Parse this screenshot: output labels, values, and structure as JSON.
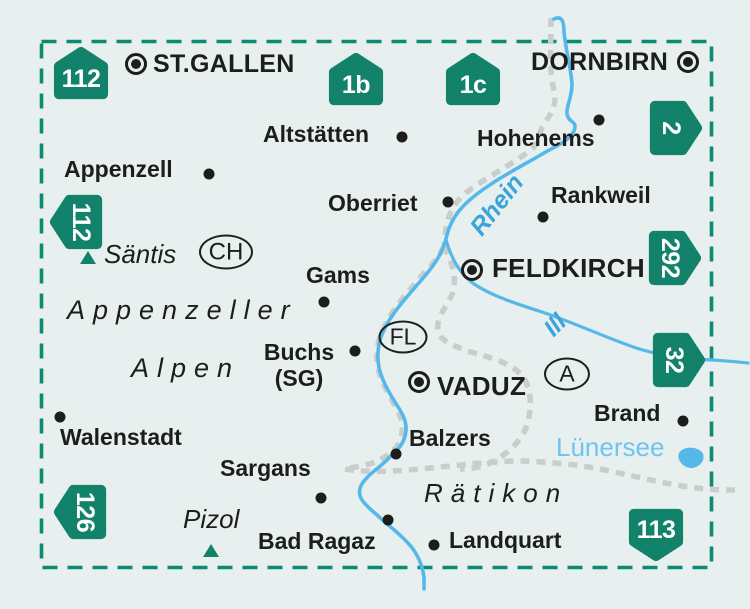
{
  "colors": {
    "background": "#e7f0ee",
    "badge_green": "#12826a",
    "border_dash_teal": "#0c8a72",
    "river_blue": "#56b8e9",
    "river_label_blue": "#3ba4dc",
    "lake_label_blue": "#70c4ee",
    "country_border_gray": "#c9cdcb",
    "text_black": "#1d1d1b"
  },
  "cities": {
    "st_gallen": "ST.GALLEN",
    "dornbirn": "DORNBIRN",
    "feldkirch": "FELDKIRCH",
    "vaduz": "VADUZ"
  },
  "towns": {
    "altstaetten": "Altstätten",
    "appenzell": "Appenzell",
    "hohenems": "Hohenems",
    "rankweil": "Rankweil",
    "oberriet": "Oberriet",
    "gams": "Gams",
    "buchs_line1": "Buchs",
    "buchs_line2": "(SG)",
    "walenstadt": "Walenstadt",
    "brand": "Brand",
    "balzers": "Balzers",
    "sargans": "Sargans",
    "bad_ragaz": "Bad Ragaz",
    "landquart": "Landquart"
  },
  "regions": {
    "appenzeller": "Appenzeller",
    "alpen": "Alpen",
    "raetikon": "Rätikon"
  },
  "peaks": {
    "saentis": "Säntis",
    "pizol": "Pizol"
  },
  "waters": {
    "rhein": "Rhein",
    "ill": "Ill",
    "luenersee": "Lünersee"
  },
  "country_codes": {
    "ch": "CH",
    "fl": "FL",
    "a": "A"
  },
  "badges": [
    {
      "label": "112",
      "orientation": "up"
    },
    {
      "label": "1b",
      "orientation": "up"
    },
    {
      "label": "1c",
      "orientation": "up"
    },
    {
      "label": "2",
      "orientation": "right"
    },
    {
      "label": "112",
      "orientation": "left"
    },
    {
      "label": "292",
      "orientation": "right"
    },
    {
      "label": "32",
      "orientation": "right"
    },
    {
      "label": "126",
      "orientation": "left"
    },
    {
      "label": "113",
      "orientation": "down"
    }
  ]
}
